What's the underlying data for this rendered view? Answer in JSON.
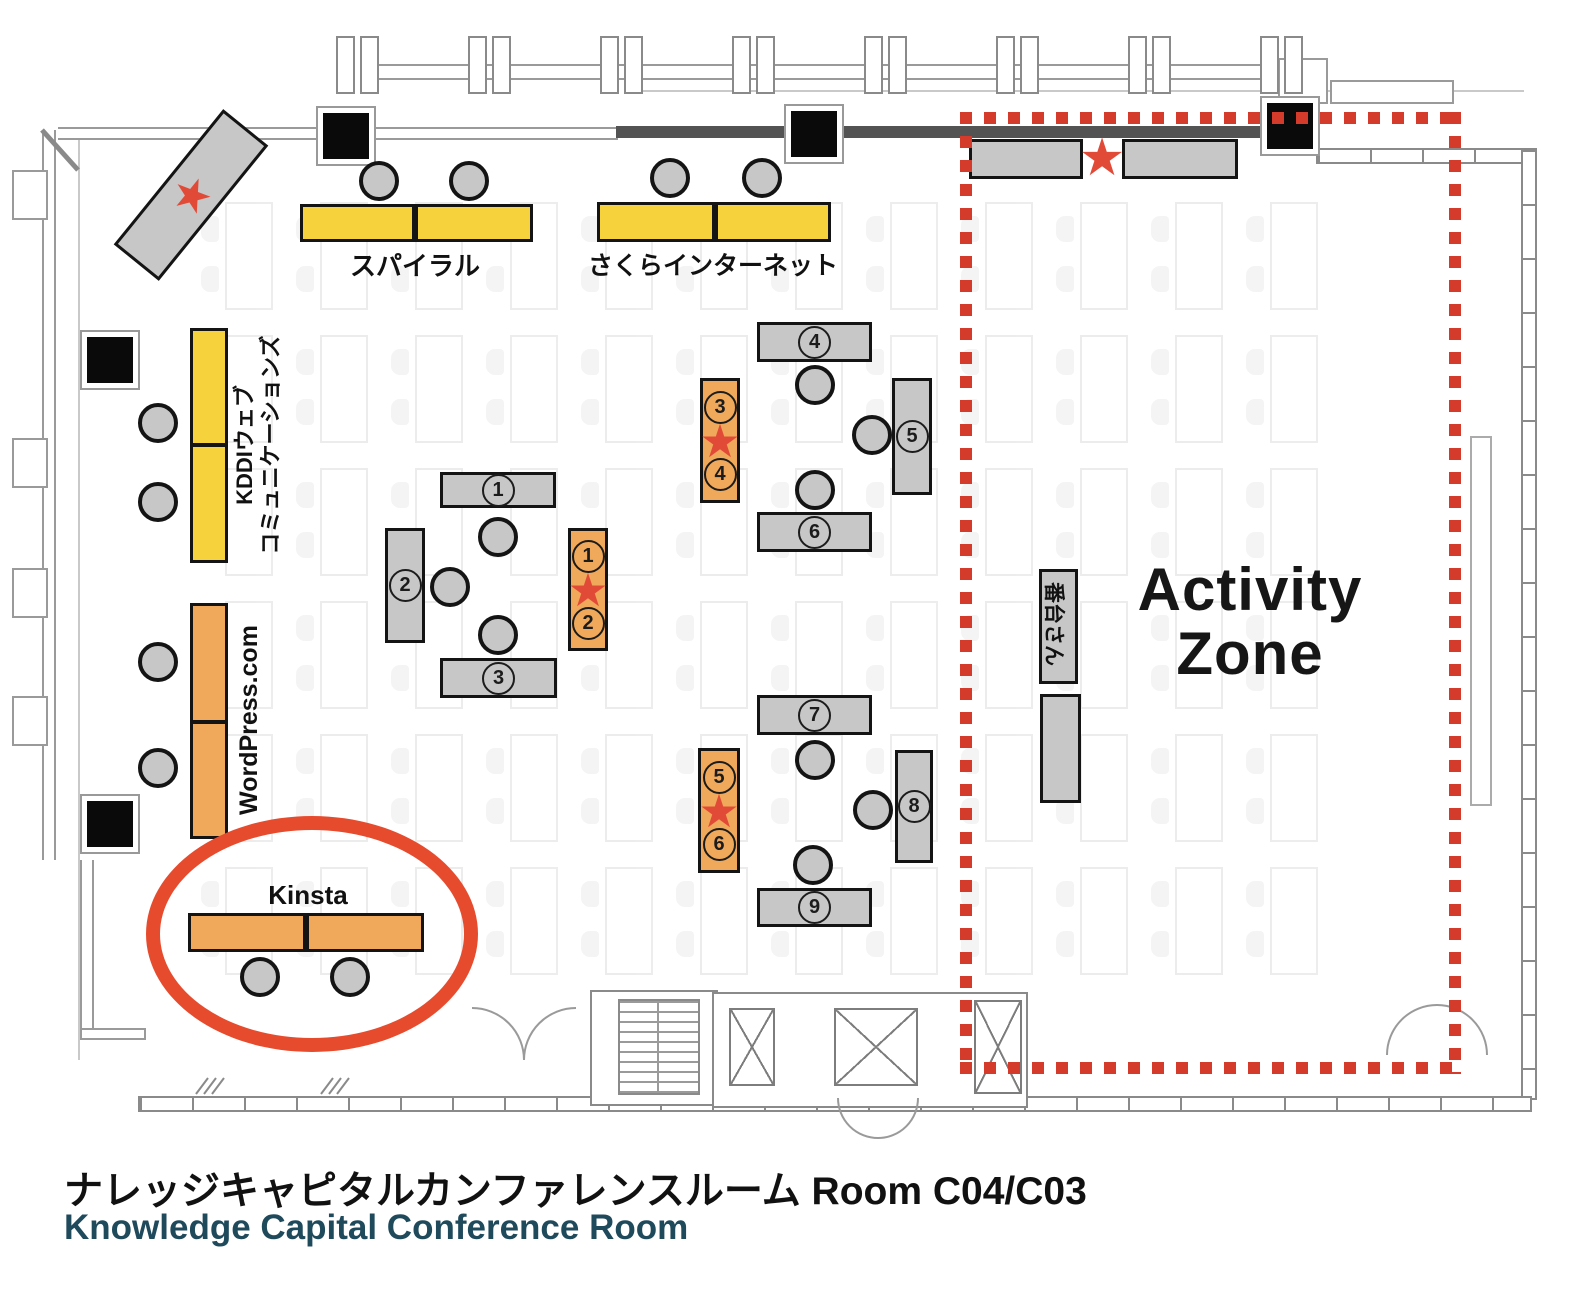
{
  "title": {
    "jp": "ナレッジキャピタルカンファレンスルーム Room C04/C03",
    "en": "Knowledge Capital Conference Room"
  },
  "booths": {
    "spiral": {
      "label": "スパイラル"
    },
    "sakura": {
      "label": "さくらインターネット"
    },
    "kddi": {
      "line1": "KDDIウェブ",
      "line2": "コミュニケーションズ"
    },
    "wordpress": {
      "label": "WordPress.com"
    },
    "kinsta": {
      "label": "Kinsta"
    },
    "bandai": {
      "label": "番台さん"
    }
  },
  "activity_zone": {
    "line1": "Activity",
    "line2": "Zone"
  },
  "numbered_tables": [
    "1",
    "2",
    "3",
    "4",
    "5",
    "6",
    "7",
    "8",
    "9"
  ],
  "star_tables": [
    {
      "top": "1",
      "bottom": "2"
    },
    {
      "top": "3",
      "bottom": "4"
    },
    {
      "top": "5",
      "bottom": "6"
    }
  ],
  "icons": {
    "star_glyph": "★"
  },
  "colors": {
    "booth_yellow": "#f6d23d",
    "booth_orange": "#f0a95a",
    "table_gray": "#c7c7c7",
    "star_red": "#e24a38",
    "zone_red": "#d43b2a",
    "highlight_red": "#e74b2e",
    "title_en": "#1f4a5c"
  }
}
